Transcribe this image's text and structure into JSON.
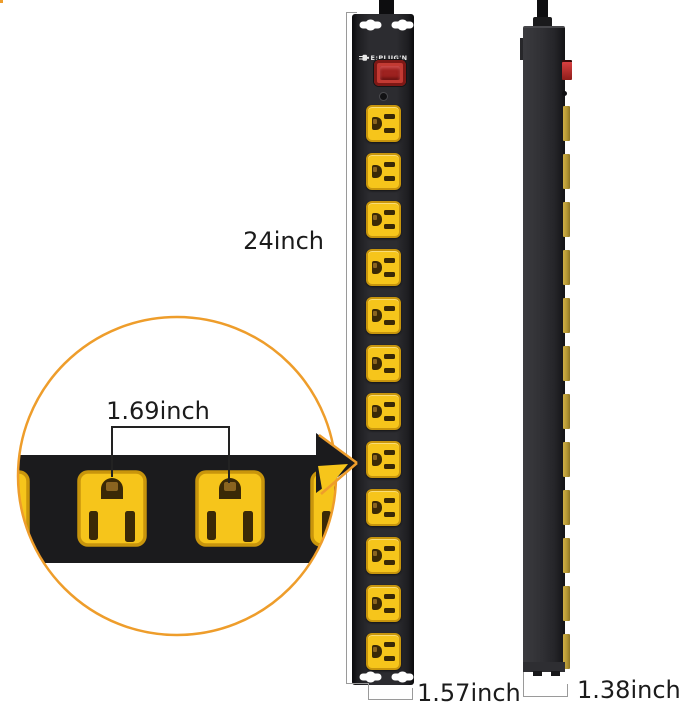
{
  "product": {
    "brand_logo": "E:PLUG'N",
    "front_outlet_count": 12,
    "side_outlet_count": 12
  },
  "dimensions": {
    "height": "24inch",
    "outlet_spacing": "1.69inch",
    "width": "1.57inch",
    "depth": "1.38inch"
  },
  "colors": {
    "accent_orange": "#EE9D2B",
    "outlet_yellow": "#F6C51B",
    "outlet_border": "#C8950C",
    "hole_brown": "#3A2906",
    "switch_red": "#C23A33",
    "side_tab_gold": "#B49735",
    "dim_line_gray": "#9A9A9A",
    "text_dark": "#1B1B1B"
  }
}
